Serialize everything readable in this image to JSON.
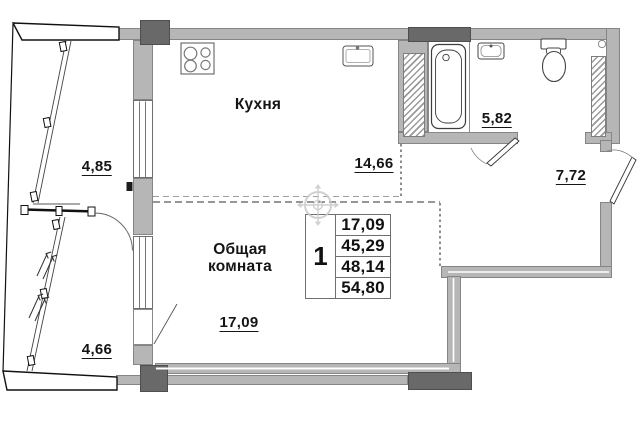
{
  "title": "План квартиры — однокомнатная",
  "rooms": {
    "kitchen": {
      "name": "Кухня",
      "area": "14,66"
    },
    "living": {
      "name": "Общая комната",
      "area": "17,09"
    },
    "bathroom": {
      "area": "5,82"
    },
    "hallway": {
      "area": "7,72"
    },
    "balcony_upper": {
      "area": "4,85"
    },
    "balcony_lower": {
      "area": "4,66"
    }
  },
  "stamp": {
    "rooms_count": "1",
    "areas": [
      "17,09",
      "45,29",
      "48,14",
      "54,80"
    ]
  },
  "colors": {
    "wall": "#b6b6b6",
    "column": "#696969",
    "line": "#151515",
    "watermark": "#c9c9c9"
  }
}
